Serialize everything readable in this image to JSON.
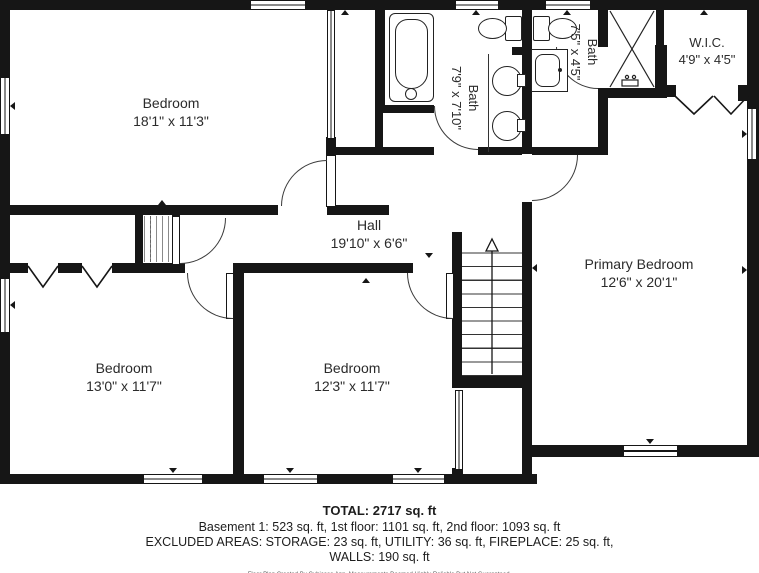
{
  "floorplan": {
    "rooms": {
      "bedroom_tl": {
        "name": "Bedroom",
        "dims": "18'1\" x 11'3\""
      },
      "bath_main": {
        "name": "Bath",
        "dims": "7'9\" x 7'10\""
      },
      "bath_small": {
        "name": "Bath",
        "dims": "7'5\" x 4'5\""
      },
      "wic": {
        "name": "W.I.C.",
        "dims": "4'9\" x 4'5\""
      },
      "hall": {
        "name": "Hall",
        "dims": "19'10\" x 6'6\""
      },
      "primary": {
        "name": "Primary Bedroom",
        "dims": "12'6\" x 20'1\""
      },
      "bedroom_bl": {
        "name": "Bedroom",
        "dims": "13'0\" x 11'7\""
      },
      "bedroom_bm": {
        "name": "Bedroom",
        "dims": "12'3\" x 11'7\""
      }
    },
    "summary": {
      "total": "TOTAL: 2717 sq. ft",
      "floors": "Basement 1: 523 sq. ft, 1st floor: 1101 sq. ft, 2nd floor: 1093 sq. ft",
      "excluded": "EXCLUDED AREAS: STORAGE: 23 sq. ft, UTILITY: 36 sq. ft, FIREPLACE: 25 sq. ft,",
      "walls": "WALLS: 190 sq. ft",
      "disclaimer": "Floor Plan Created By Cubicasa App. Measurements Deemed Highly Reliable But Not Guaranteed."
    },
    "colors": {
      "wall": "#161616",
      "text": "#2b2b2b",
      "background": "#ffffff"
    }
  }
}
